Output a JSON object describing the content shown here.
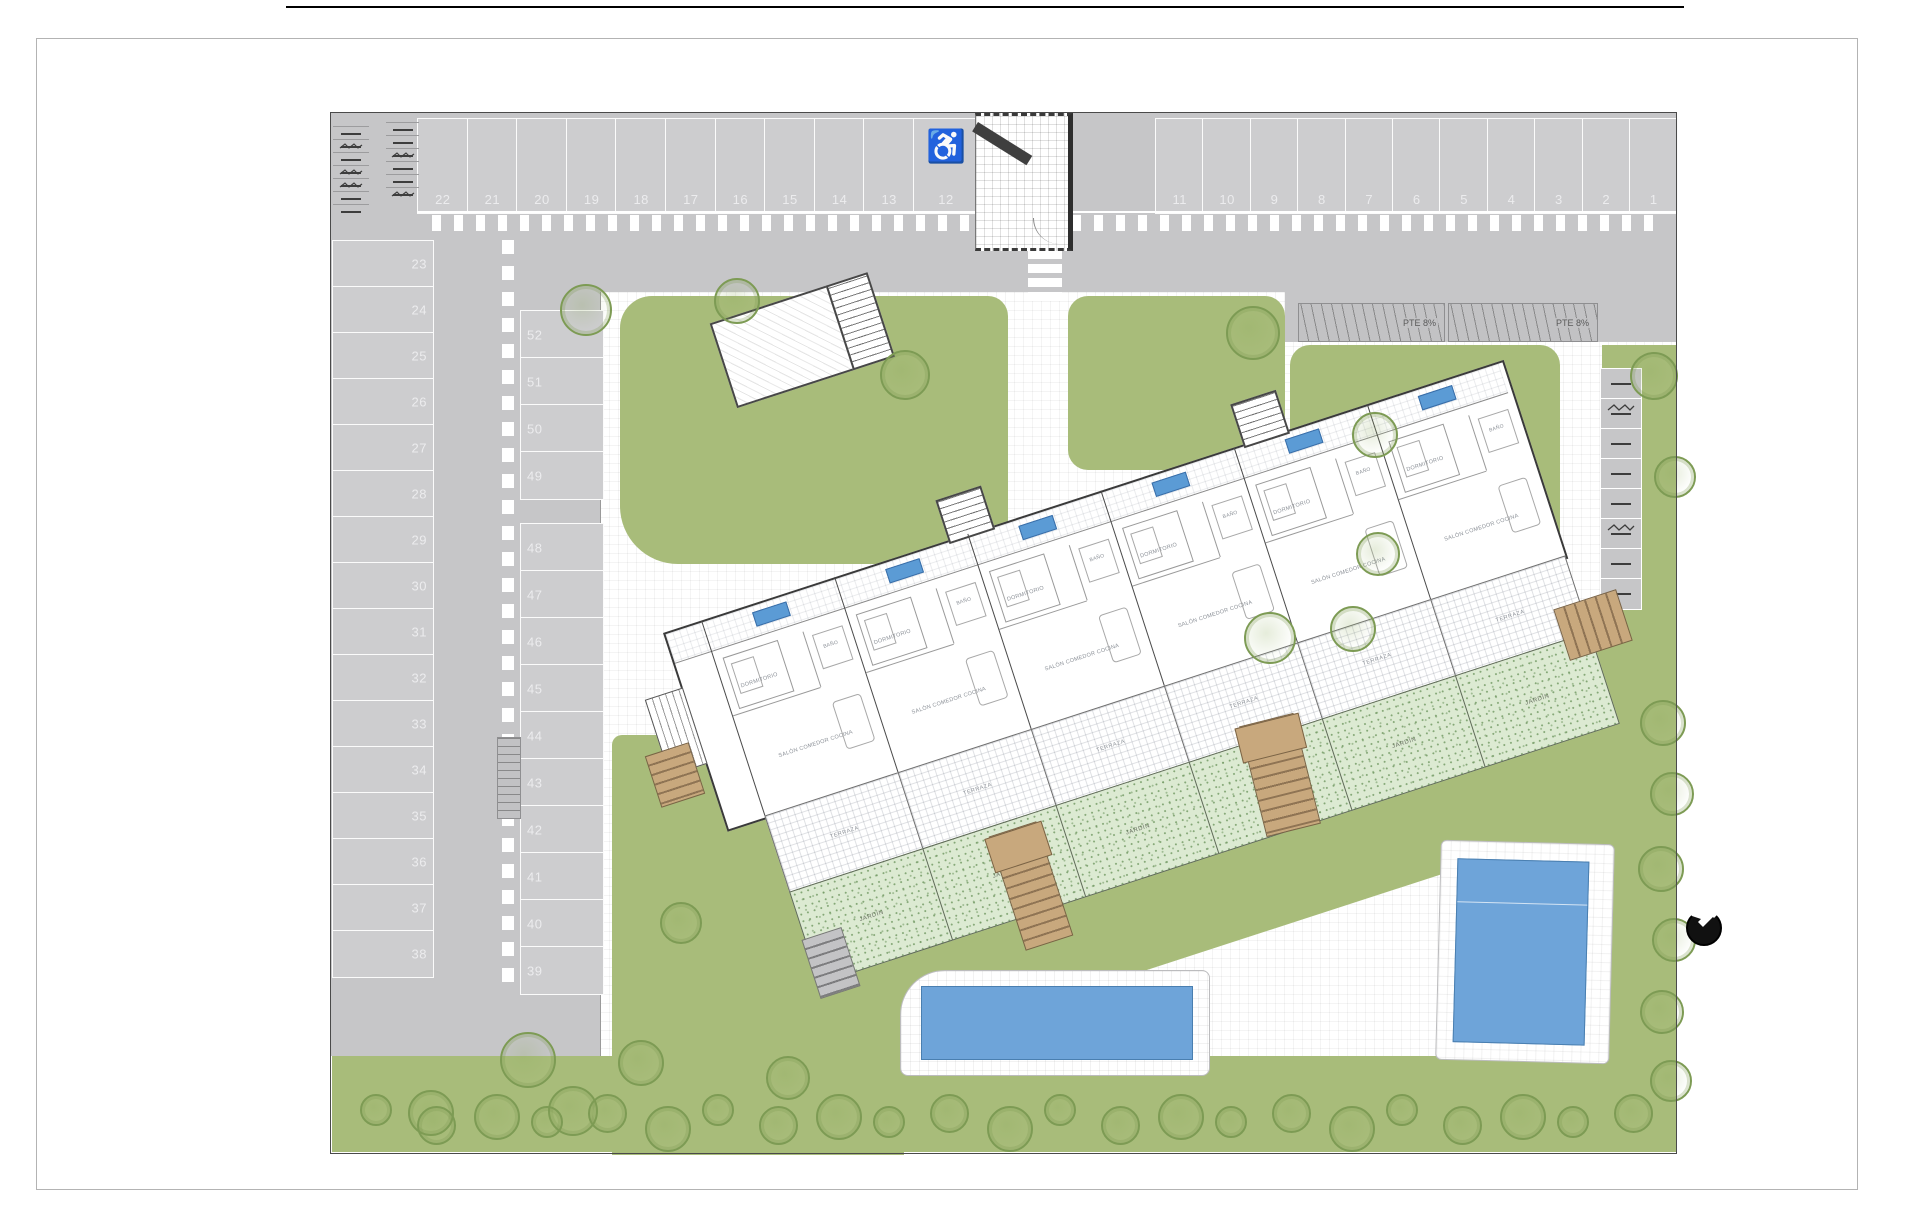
{
  "parking": {
    "top_row_left": [
      "22",
      "21",
      "20",
      "19",
      "18",
      "17",
      "16",
      "15",
      "14",
      "13"
    ],
    "accessible_space": {
      "number": "12",
      "icon": "wheelchair-symbol"
    },
    "top_row_right": [
      "11",
      "10",
      "9",
      "8",
      "7",
      "6",
      "5",
      "4",
      "3",
      "2",
      "1"
    ],
    "west_column": [
      "23",
      "24",
      "25",
      "26",
      "27",
      "28",
      "29",
      "30",
      "31",
      "32",
      "33",
      "34",
      "35",
      "36",
      "37",
      "38"
    ],
    "inner_column_upper": [
      "52",
      "51",
      "50",
      "49"
    ],
    "inner_column_lower": [
      "48",
      "47",
      "46",
      "45",
      "44",
      "43",
      "42",
      "41",
      "40",
      "39"
    ]
  },
  "ramps": {
    "labels": [
      "PTE 8%",
      "PTE 8%"
    ]
  },
  "building": {
    "units": 6,
    "room_labels": {
      "living": "SALÓN COMEDOR COCINA",
      "bedroom": "DORMITORIO",
      "bath": "BAÑO",
      "terrace": "TERRAZA",
      "garden": "JARDÍN"
    }
  },
  "pools": {
    "count": 2
  },
  "compass": {
    "icon": "north-arrow"
  },
  "icons": {
    "bike": "bicycle-icon",
    "moto": "motorcycle-icon"
  },
  "colors": {
    "pavement": "#c6c6c8",
    "pavement_light": "#cdcdcf",
    "lawn": "#a8bc7a",
    "private_garden": "#dcead2",
    "pool": "#6ea4d9",
    "wood_deck": "#c8a87d",
    "unit_badge": "#5b9bd5"
  }
}
